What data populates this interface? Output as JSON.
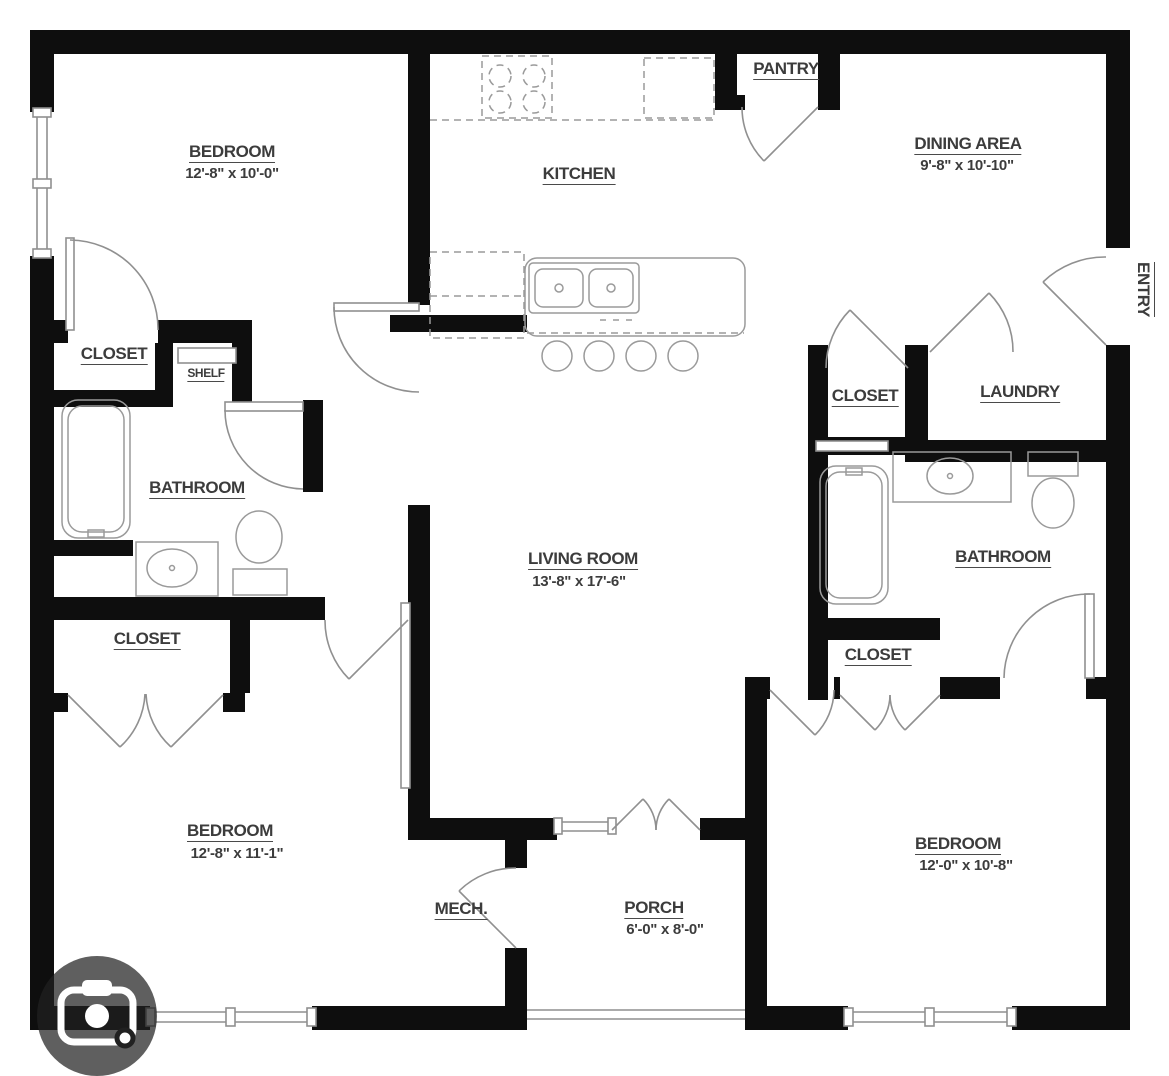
{
  "rooms": {
    "bedroom1": {
      "label": "BEDROOM",
      "dims": "12'-8\" x 10'-0\""
    },
    "kitchen": {
      "label": "KITCHEN"
    },
    "pantry": {
      "label": "PANTRY"
    },
    "dining": {
      "label": "DINING AREA",
      "dims": "9'-8\" x 10'-10\""
    },
    "entry": {
      "label": "ENTRY"
    },
    "closet_top_left": {
      "label": "CLOSET"
    },
    "shelf": {
      "label": "SHELF"
    },
    "bathroom_left": {
      "label": "BATHROOM"
    },
    "closet_lower_left": {
      "label": "CLOSET"
    },
    "closet_upper_right": {
      "label": "CLOSET"
    },
    "laundry": {
      "label": "LAUNDRY"
    },
    "living_room": {
      "label": "LIVING ROOM",
      "dims": "13'-8\" x 17'-6\""
    },
    "bathroom_right": {
      "label": "BATHROOM"
    },
    "closet_lower_right": {
      "label": "CLOSET"
    },
    "bedroom2": {
      "label": "BEDROOM",
      "dims": "12'-8\" x 11'-1\""
    },
    "mech": {
      "label": "MECH."
    },
    "porch": {
      "label": "PORCH",
      "dims": "6'-0\" x 8'-0\""
    },
    "bedroom3": {
      "label": "BEDROOM",
      "dims": "12'-0\" x 10'-8\""
    }
  },
  "icons": {
    "camera": "camera-icon"
  },
  "colors": {
    "wall": "#0e0e0e",
    "linework": "#8f8f8f",
    "label_text": "#3c3c3c",
    "camera_overlay": "rgba(33,33,33,0.72)",
    "camera_glyph": "#ffffff"
  }
}
